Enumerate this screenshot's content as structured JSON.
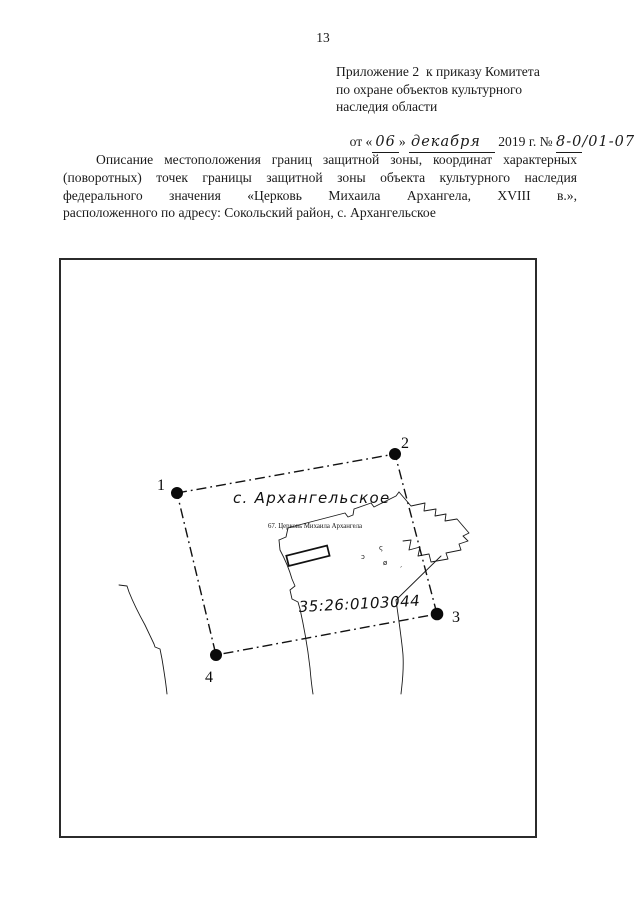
{
  "page": {
    "number": "13"
  },
  "appendix": {
    "lines": [
      "Приложение 2  к приказу Комитета",
      "по охране объектов культурного",
      "наследия области"
    ],
    "date": {
      "prefix": "от «",
      "day": "06",
      "after_day": "» ",
      "month": "декабря",
      "year_part": " 2019 г. № ",
      "number_underlined": "8-0",
      "number_rest": "/01-07"
    }
  },
  "description": {
    "lines": [
      "Описание местоположения границ защитной зоны, координат характерных",
      "(поворотных) точек границы защитной зоны объекта культурного наследия",
      "федерального значения «Церковь Михаила Архангела, XVIII в.»,",
      "расположенного по адресу:  Сокольский район, с. Архангельское"
    ]
  },
  "map": {
    "village_label": "с. Архангельское",
    "church_label": "67. Церковь Михаила Архангела",
    "cadastral_number": "35:26:0103044",
    "points": [
      {
        "label": "1"
      },
      {
        "label": "2"
      },
      {
        "label": "3"
      },
      {
        "label": "4"
      }
    ],
    "symbols": [
      "ς",
      "ɔ",
      "ø",
      "ˏ"
    ]
  }
}
